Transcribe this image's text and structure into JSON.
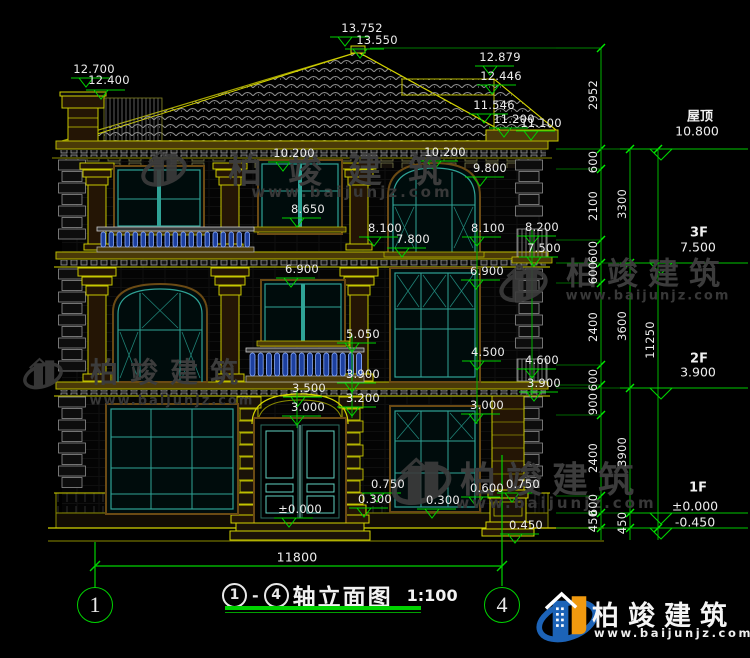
{
  "title": {
    "axis_from": "1",
    "axis_to": "4",
    "dash": "-",
    "name": "轴立面图",
    "scale": "1:100"
  },
  "bottom": {
    "total_width": "11800",
    "axis_left": "1",
    "axis_right": "4"
  },
  "brand": {
    "name": "柏竣建筑",
    "url": "www.baijunjz.com"
  },
  "floor_marks": [
    {
      "name": "屋顶",
      "nx": 700,
      "ny": 115,
      "value": "10.800",
      "vx": 697,
      "vy": 131,
      "ly": 149
    },
    {
      "name": "3F",
      "nx": 699,
      "ny": 233,
      "value": "7.500",
      "vx": 698,
      "vy": 247,
      "ly": 263
    },
    {
      "name": "2F",
      "nx": 699,
      "ny": 359,
      "value": "3.900",
      "vx": 698,
      "vy": 372,
      "ly": 388
    },
    {
      "name": "1F",
      "nx": 698,
      "ny": 488,
      "value": "±0.000",
      "vx": 695,
      "vy": 506,
      "ly": 513
    },
    {
      "name": "",
      "nx": 698,
      "ny": 522,
      "value": "-0.450",
      "vx": 695,
      "vy": 522,
      "ly": 528
    }
  ],
  "labels": [
    {
      "t": "13.752",
      "x": 362,
      "y": 28
    },
    {
      "t": "13.550",
      "x": 377,
      "y": 40
    },
    {
      "t": "12.700",
      "x": 94,
      "y": 69
    },
    {
      "t": "12.400",
      "x": 109,
      "y": 80
    },
    {
      "t": "12.879",
      "x": 500,
      "y": 57
    },
    {
      "t": "12.446",
      "x": 501,
      "y": 76
    },
    {
      "t": "11.546",
      "x": 494,
      "y": 105
    },
    {
      "t": "11.200",
      "x": 514,
      "y": 119
    },
    {
      "t": "11.100",
      "x": 541,
      "y": 123
    },
    {
      "t": "10.200",
      "x": 294,
      "y": 153
    },
    {
      "t": "10.200",
      "x": 445,
      "y": 152
    },
    {
      "t": "9.800",
      "x": 490,
      "y": 168
    },
    {
      "t": "8.650",
      "x": 308,
      "y": 209
    },
    {
      "t": "8.100",
      "x": 385,
      "y": 228
    },
    {
      "t": "7.800",
      "x": 413,
      "y": 239
    },
    {
      "t": "8.100",
      "x": 488,
      "y": 228
    },
    {
      "t": "8.200",
      "x": 542,
      "y": 227
    },
    {
      "t": "7.500",
      "x": 544,
      "y": 248
    },
    {
      "t": "6.900",
      "x": 302,
      "y": 269
    },
    {
      "t": "6.900",
      "x": 487,
      "y": 271
    },
    {
      "t": "5.050",
      "x": 363,
      "y": 334
    },
    {
      "t": "4.500",
      "x": 488,
      "y": 352
    },
    {
      "t": "4.600",
      "x": 542,
      "y": 360
    },
    {
      "t": "3.900",
      "x": 544,
      "y": 383
    },
    {
      "t": "3.900",
      "x": 363,
      "y": 374
    },
    {
      "t": "3.500",
      "x": 309,
      "y": 388
    },
    {
      "t": "3.200",
      "x": 363,
      "y": 398
    },
    {
      "t": "3.000",
      "x": 308,
      "y": 407
    },
    {
      "t": "3.000",
      "x": 487,
      "y": 405
    },
    {
      "t": "0.750",
      "x": 388,
      "y": 484
    },
    {
      "t": "0.300",
      "x": 375,
      "y": 499
    },
    {
      "t": "0.300",
      "x": 443,
      "y": 500
    },
    {
      "t": "0.600",
      "x": 487,
      "y": 488
    },
    {
      "t": "0.750",
      "x": 523,
      "y": 484
    },
    {
      "t": "±0.000",
      "x": 300,
      "y": 509
    },
    {
      "t": "0.450",
      "x": 526,
      "y": 525
    }
  ],
  "markers": [
    [
      345,
      37
    ],
    [
      360,
      49
    ],
    [
      86,
      78
    ],
    [
      101,
      90
    ],
    [
      490,
      66
    ],
    [
      492,
      85
    ],
    [
      484,
      114
    ],
    [
      504,
      128
    ],
    [
      531,
      131
    ],
    [
      283,
      162
    ],
    [
      434,
      161
    ],
    [
      480,
      177
    ],
    [
      297,
      218
    ],
    [
      374,
      237
    ],
    [
      402,
      248
    ],
    [
      477,
      237
    ],
    [
      532,
      236
    ],
    [
      534,
      257
    ],
    [
      291,
      278
    ],
    [
      476,
      280
    ],
    [
      352,
      343
    ],
    [
      477,
      361
    ],
    [
      532,
      369
    ],
    [
      534,
      392
    ],
    [
      352,
      383
    ],
    [
      298,
      397
    ],
    [
      352,
      407
    ],
    [
      297,
      416
    ],
    [
      476,
      414
    ],
    [
      377,
      493
    ],
    [
      364,
      508
    ],
    [
      432,
      509
    ],
    [
      476,
      497
    ],
    [
      512,
      493
    ],
    [
      289,
      518
    ],
    [
      515,
      534
    ]
  ],
  "chain": {
    "col1": {
      "x": 601,
      "ticks": [
        48,
        149,
        169,
        240,
        263,
        283,
        365,
        385,
        415,
        496,
        513,
        528
      ],
      "labels": [
        {
          "t": "2952",
          "y": 95
        },
        {
          "t": "600",
          "y": 162
        },
        {
          "t": "2100",
          "y": 206
        },
        {
          "t": "600",
          "y": 252
        },
        {
          "t": "600",
          "y": 273
        },
        {
          "t": "2400",
          "y": 327
        },
        {
          "t": "600",
          "y": 380
        },
        {
          "t": "900",
          "y": 404
        },
        {
          "t": "2400",
          "y": 458
        },
        {
          "t": "600",
          "y": 505
        },
        {
          "t": "450",
          "y": 521
        }
      ]
    },
    "col2": {
      "x": 630,
      "ticks": [
        149,
        263,
        388,
        513,
        528
      ],
      "labels": [
        {
          "t": "3300",
          "y": 204
        },
        {
          "t": "3600",
          "y": 326
        },
        {
          "t": "3900",
          "y": 452
        },
        {
          "t": "450",
          "y": 523
        }
      ]
    },
    "col3": {
      "x": 658,
      "ticks": [
        149,
        528
      ],
      "labels": [
        {
          "t": "11250",
          "y": 340
        }
      ]
    }
  },
  "watermarks": [
    {
      "ix": 170,
      "iy": 174,
      "is": 0.8,
      "tx": 348,
      "ty": 168,
      "ts": 34,
      "tls": 26,
      "ux": 352,
      "uy": 192,
      "us": 15,
      "uls": 3
    },
    {
      "ix": 528,
      "iy": 287,
      "is": 0.85,
      "tx": 648,
      "ty": 271,
      "ts": 31,
      "tls": 10,
      "ux": 648,
      "uy": 296,
      "us": 13,
      "uls": 2
    },
    {
      "ix": 52,
      "iy": 382,
      "is": 0.7,
      "tx": 170,
      "ty": 371,
      "ts": 28,
      "tls": 12,
      "ux": 172,
      "uy": 401,
      "us": 13,
      "uls": 2
    },
    {
      "ix": 420,
      "iy": 479,
      "is": 1.05,
      "tx": 552,
      "ty": 477,
      "ts": 36,
      "tls": 10,
      "ux": 556,
      "uy": 503,
      "us": 15,
      "uls": 3
    }
  ]
}
